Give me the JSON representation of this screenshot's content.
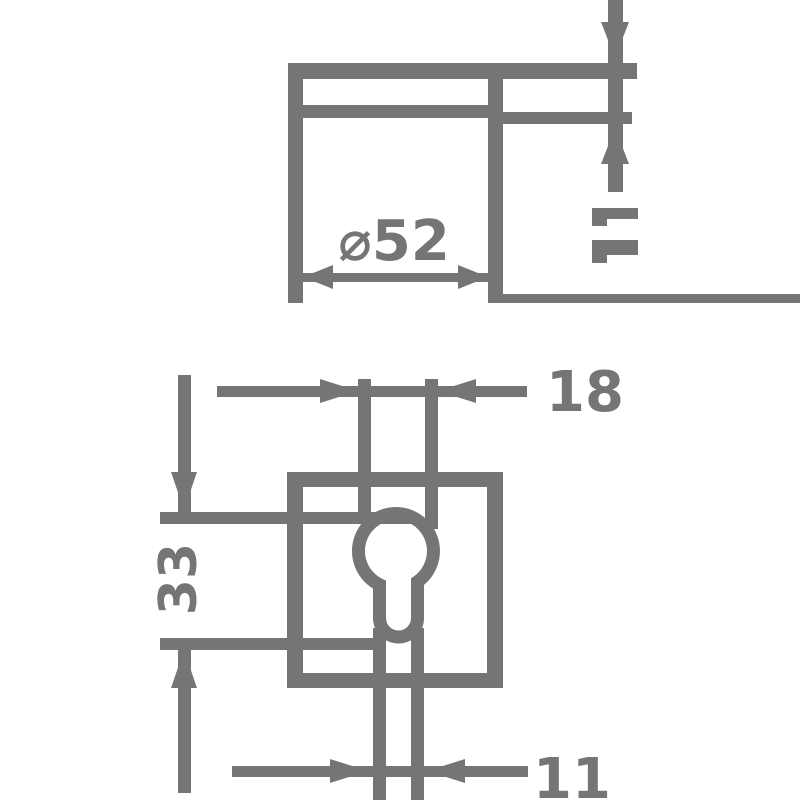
{
  "colors": {
    "line": "#757575",
    "background": "#ffffff"
  },
  "side_view": {
    "diameter_label": "⌀52"
  },
  "front_view": {
    "keyhole_width_label": "18",
    "keyhole_height_label": "33",
    "keyhole_stem_width_label": "11"
  }
}
